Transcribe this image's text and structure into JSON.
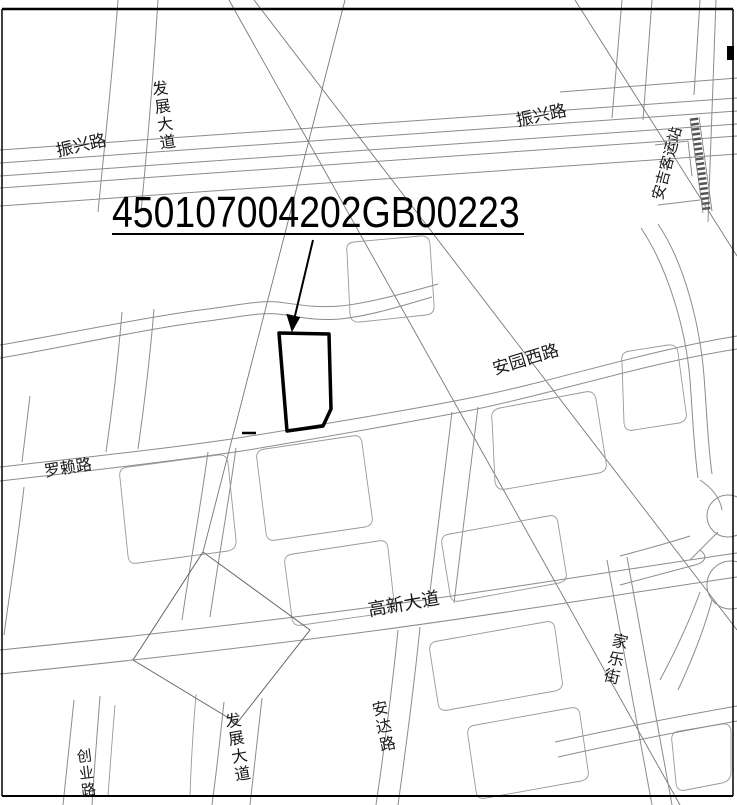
{
  "map": {
    "parcel": {
      "id": "450107004202GB00223"
    },
    "roads": {
      "zhenxing_west": "振兴路",
      "zhenxing_east": "振兴路",
      "fazhan_north": "发展大道",
      "fazhan_south": "发展大道",
      "anyuan_west": "安园西路",
      "luolai": "罗赖路",
      "gaoxin": "高新大道",
      "anda": "安达路",
      "jiale": "家乐街",
      "chuangye": "创业路"
    },
    "poi": {
      "anji_station": "安吉客运站"
    },
    "colors": {
      "line": "#8c8c8c",
      "overlay": "#777777",
      "bold": "#000000",
      "background": "#ffffff"
    }
  }
}
